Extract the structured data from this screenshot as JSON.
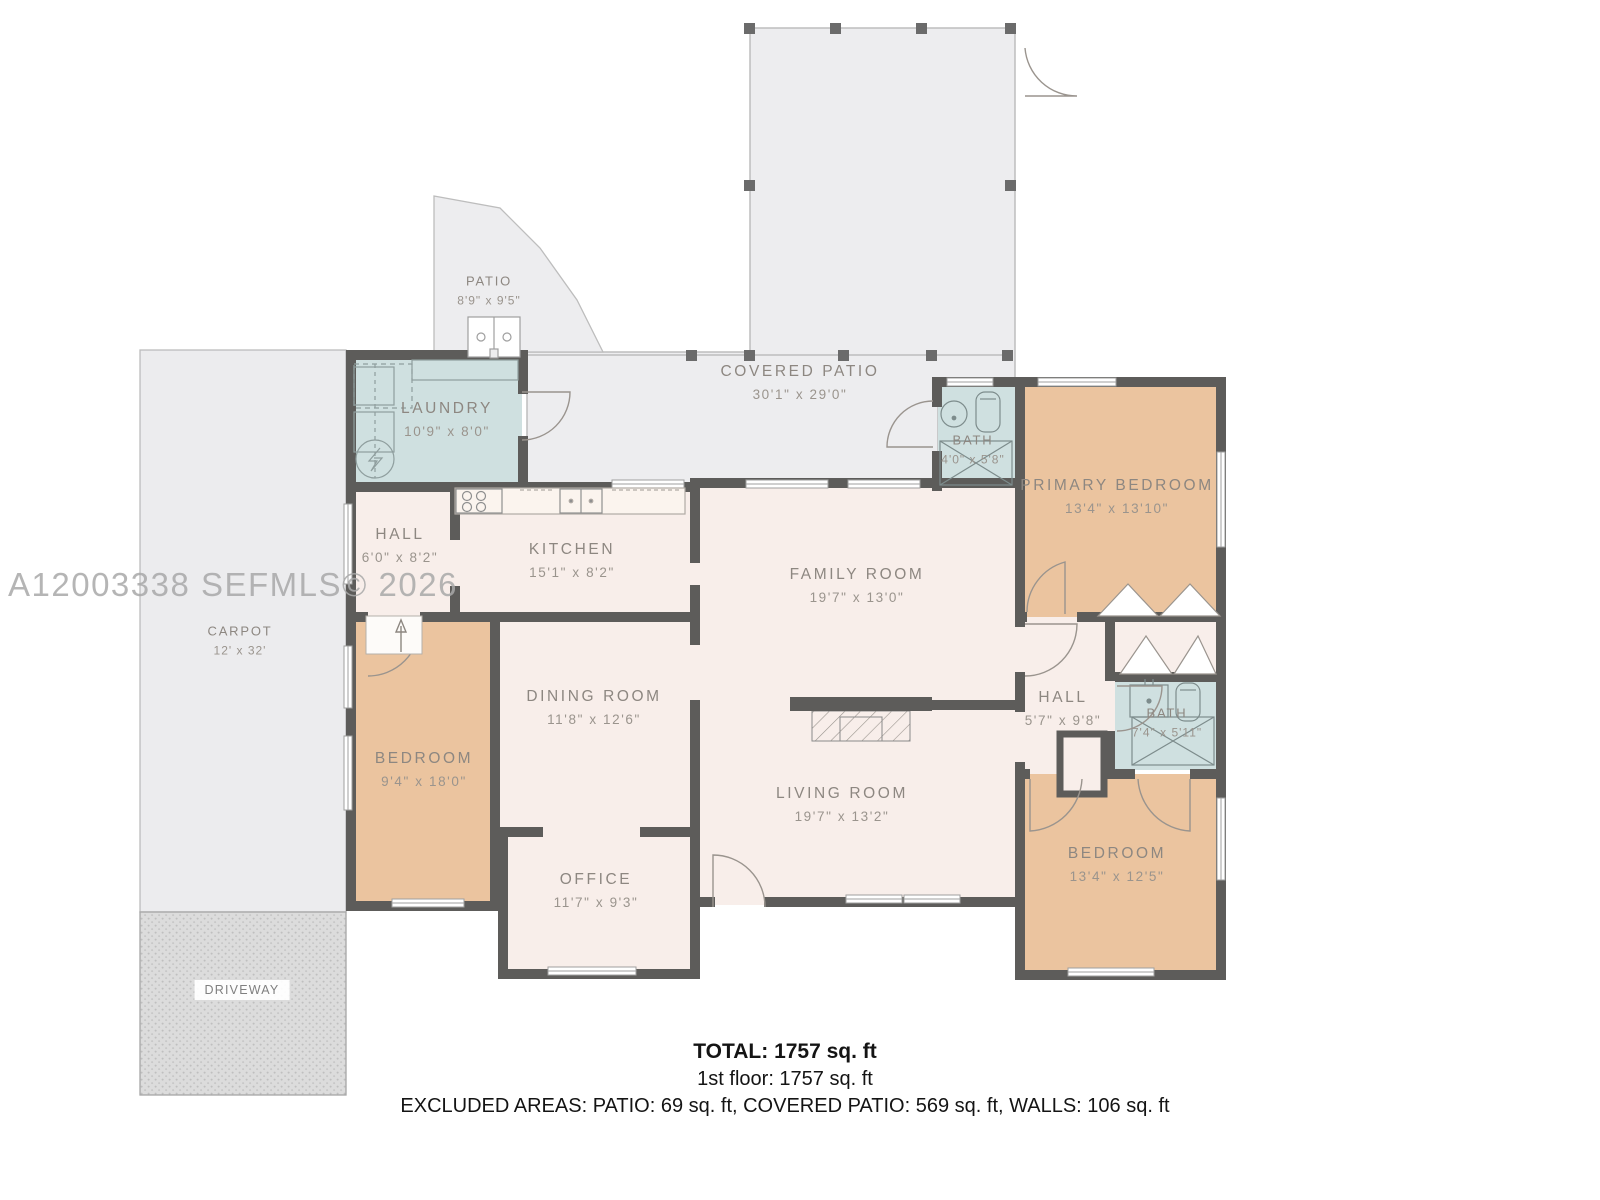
{
  "watermark": "A12003338  SEFMLS© 2026",
  "rooms": {
    "patio": {
      "name": "PATIO",
      "dims": "8'9\" x 9'5\""
    },
    "covered_patio": {
      "name": "COVERED PATIO",
      "dims": "30'1\" x 29'0\""
    },
    "laundry": {
      "name": "LAUNDRY",
      "dims": "10'9\" x 8'0\""
    },
    "bath_top": {
      "name": "BATH",
      "dims": "4'0\" x 5'8\""
    },
    "primary_bedroom": {
      "name": "PRIMARY BEDROOM",
      "dims": "13'4\" x 13'10\""
    },
    "hall_top": {
      "name": "HALL",
      "dims": "6'0\" x 8'2\""
    },
    "kitchen": {
      "name": "KITCHEN",
      "dims": "15'1\" x 8'2\""
    },
    "family_room": {
      "name": "FAMILY ROOM",
      "dims": "19'7\" x 13'0\""
    },
    "carport": {
      "name": "CARPOT",
      "dims": "12'  x  32'"
    },
    "dining_room": {
      "name": "DINING ROOM",
      "dims": "11'8\" x 12'6\""
    },
    "hall_right": {
      "name": "HALL",
      "dims": "5'7\" x 9'8\""
    },
    "bath_right": {
      "name": "BATH",
      "dims": "7'4\" x 5'11\""
    },
    "bedroom_left": {
      "name": "BEDROOM",
      "dims": "9'4\" x 18'0\""
    },
    "living_room": {
      "name": "LIVING ROOM",
      "dims": "19'7\" x 13'2\""
    },
    "bedroom_right": {
      "name": "BEDROOM",
      "dims": "13'4\" x 12'5\""
    },
    "office": {
      "name": "OFFICE",
      "dims": "11'7\" x 9'3\""
    },
    "driveway": {
      "name": "DRIVEWAY"
    }
  },
  "summary": {
    "total": "TOTAL: 1757 sq. ft",
    "floor": "1st floor: 1757 sq. ft",
    "excluded": "EXCLUDED AREAS: PATIO: 69 sq. ft, COVERED PATIO: 569 sq. ft, WALLS: 106 sq. ft"
  },
  "colors": {
    "walls": "#5d5c5a",
    "floor": "#f8eeea",
    "bedroom": "#ebc49f",
    "wet_rooms": "#cfe0e0",
    "patio": "#ededef"
  }
}
